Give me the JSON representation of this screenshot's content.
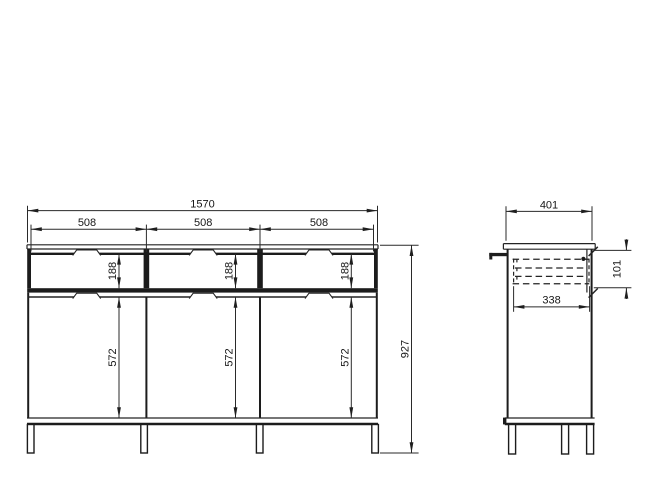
{
  "drawing": {
    "type": "furniture technical drawing, sideboard front and side elevation with dimensions",
    "units": "mm",
    "colors": {
      "background": "#ffffff",
      "line": "#1c1c1c",
      "text": "#161616"
    },
    "front_view": {
      "total_width": "1570",
      "section_widths": [
        "508",
        "508",
        "508"
      ],
      "drawer_front_heights": [
        "188",
        "188",
        "188"
      ],
      "door_heights": [
        "572",
        "572",
        "572"
      ],
      "total_height": "927"
    },
    "side_view": {
      "total_depth": "401",
      "drawer_inner_depth": "338",
      "drawer_box_height": "101"
    }
  }
}
